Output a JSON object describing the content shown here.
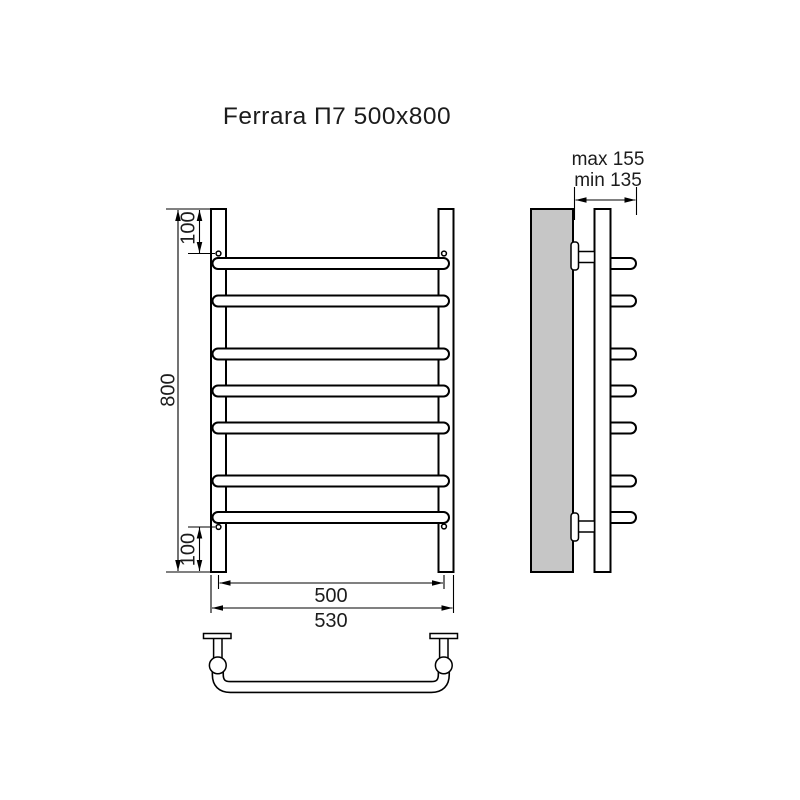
{
  "title": "Ferrara П7 500x800",
  "colors": {
    "line": "#000000",
    "paper": "#ffffff",
    "wall_fill": "#c6c6c6",
    "text": "#1c1c1c"
  },
  "front_view": {
    "height_label": "800",
    "top_offset_label": "100",
    "bottom_offset_label": "100",
    "axis_width_label": "500",
    "overall_width_label": "530",
    "rung_count": 7
  },
  "side_view": {
    "wall_clearance_max_label": "max 155",
    "wall_clearance_min_label": "min 135"
  }
}
